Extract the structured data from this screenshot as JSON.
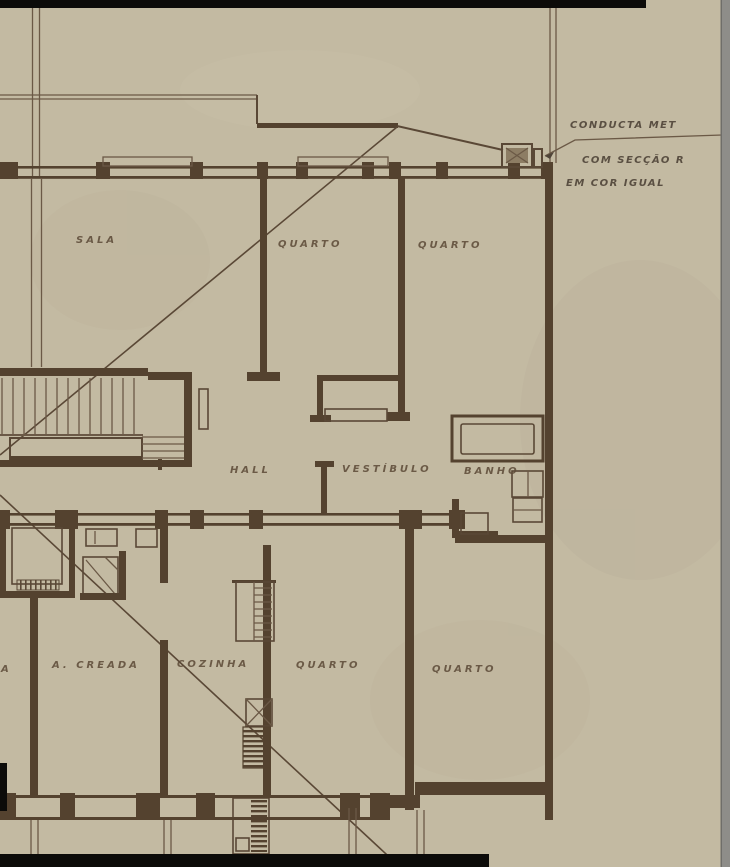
{
  "document": {
    "kind": "Scanned architectural floor plan (Portuguese)",
    "annotation_note": {
      "line1": "CONDUCTA MET",
      "line2": "COM SECÇÃO R",
      "line3": "EM COR IGUAL"
    },
    "room_labels": {
      "sala": "SALA",
      "quarto_top_left": "QUARTO",
      "quarto_top_right": "QUARTO",
      "hall": "HALL",
      "vestibulo": "VESTÍBULO",
      "banho": "BANHO",
      "creada": "A. CREADA",
      "cozinha": "COZINHA",
      "quarto_bottom_left": "QUARTO",
      "quarto_bottom_right": "QUARTO",
      "edge_partial": "A"
    },
    "colors": {
      "paper": "#c3baa2",
      "ink_wall": "#54422f",
      "ink_line": "#6b5946",
      "ink_text": "#5f4d3a",
      "scan_border_black": "#0c0b09",
      "scan_edge_gray": "#8e8d89"
    }
  }
}
